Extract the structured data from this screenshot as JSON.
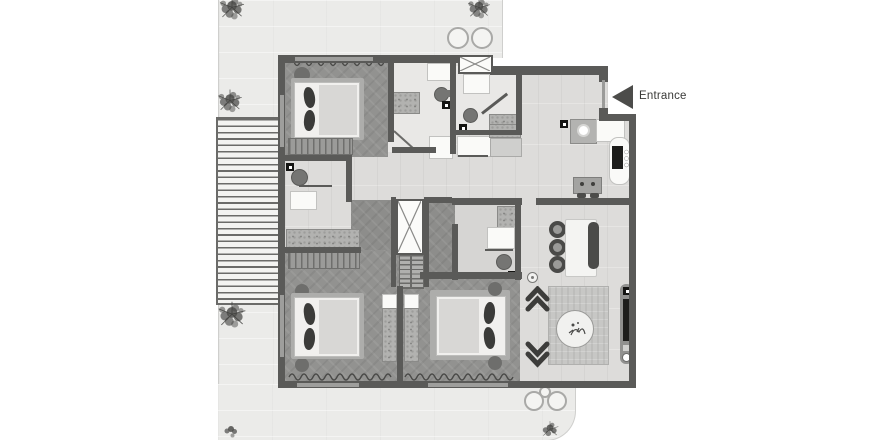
{
  "plan": {
    "entrance_label": "Entrance",
    "colors": {
      "wall": "#5a5a58",
      "floor_light": "#dddcda",
      "floor_dark": "#929290",
      "terrace": "#ebebe9",
      "deck_line": "#6b6b69",
      "furniture_dark": "#3b3b39",
      "accent": "#4c4c4a",
      "page_background": "#ffffff"
    }
  }
}
